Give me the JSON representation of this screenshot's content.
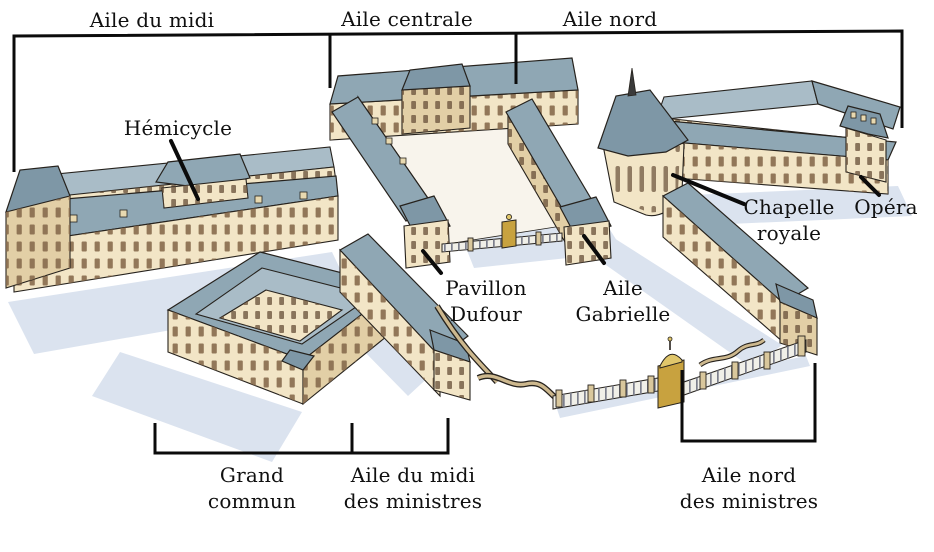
{
  "labels": {
    "aile_du_midi": "Aile du midi",
    "aile_centrale": "Aile centrale",
    "aile_nord": "Aile nord",
    "hemicycle": "Hémicycle",
    "chapelle_royale": "Chapelle\nroyale",
    "opera": "Opéra",
    "pavillon_dufour": "Pavillon\nDufour",
    "aile_gabrielle": "Aile\nGabrielle",
    "grand_commun": "Grand\ncommun",
    "aile_du_midi_des_ministres": "Aile du midi\ndes ministres",
    "aile_nord_des_ministres": "Aile nord\ndes ministres"
  },
  "colors": {
    "background": "#ffffff",
    "annotation": "#0b0b0b",
    "roof": "#8fa7b4",
    "roof_light": "#a9bcc7",
    "roof_dark": "#7e97a6",
    "wall": "#f2e5c6",
    "wall_shade": "#e2cfa6",
    "shadow": "#dbe3ef",
    "gold": "#c8a23f",
    "outline": "#26221d"
  }
}
